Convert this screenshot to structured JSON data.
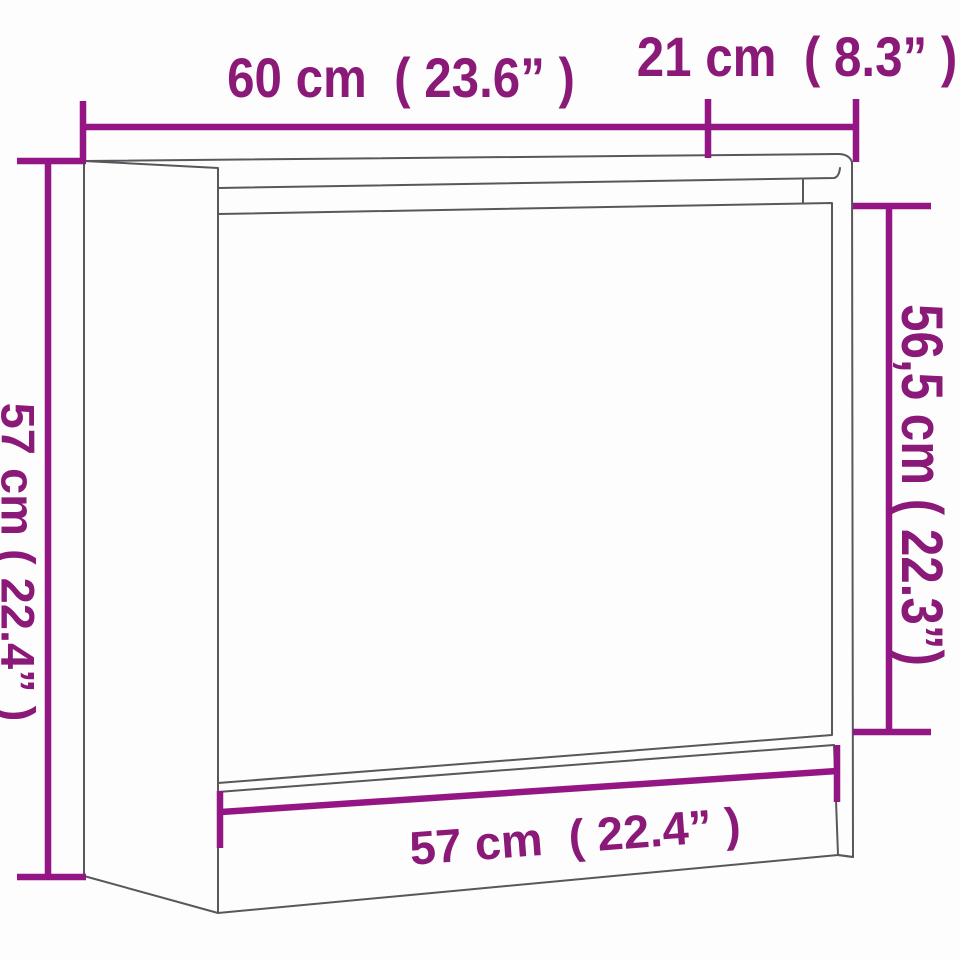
{
  "diagram": {
    "subject": "shoe-cabinet dimension line drawing",
    "view": "front three-quarter perspective",
    "background_color": "#fdfdfd",
    "outline_color": "#58585c",
    "dimension_line_color": "#941685",
    "label_color": "#8a1977",
    "measurements": [
      {
        "id": "top-width",
        "cm": "60",
        "inch": "23.6",
        "label": "60 cm  ( 23.6” )",
        "position": "top",
        "orientation": "horizontal"
      },
      {
        "id": "top-depth",
        "cm": "21",
        "inch": "8.3",
        "label": "21 cm  ( 8.3” )",
        "position": "top-right",
        "orientation": "horizontal"
      },
      {
        "id": "left-height",
        "cm": "57",
        "inch": "22.4",
        "label": "57 cm ( 22.4” )",
        "position": "left",
        "orientation": "vertical-rotated-90"
      },
      {
        "id": "right-height",
        "cm": "56,5",
        "inch": "22.3",
        "label": "56,5 cm ( 22.3”)",
        "position": "right",
        "orientation": "vertical-rotated-90"
      },
      {
        "id": "bottom-width",
        "cm": "57",
        "inch": "22.4",
        "label": "57 cm  ( 22.4” )",
        "position": "bottom",
        "orientation": "tilted"
      }
    ]
  }
}
